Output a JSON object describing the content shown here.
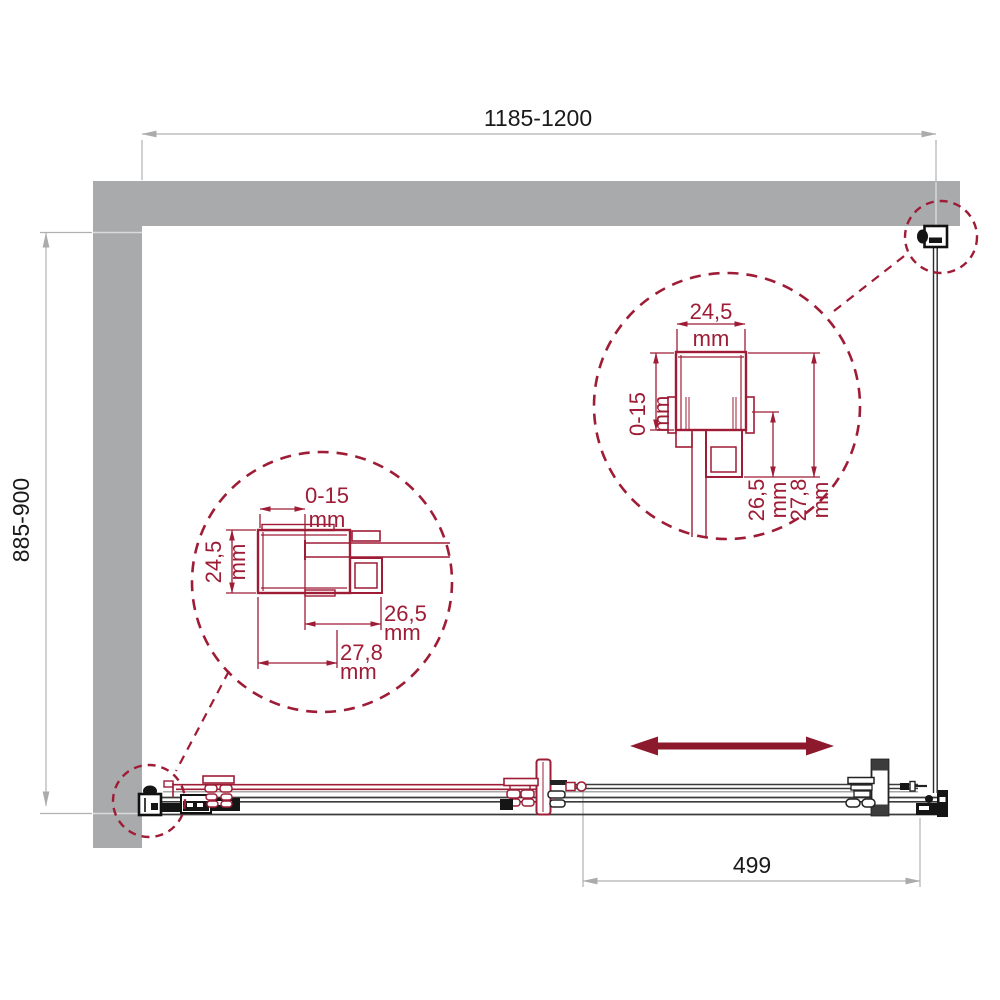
{
  "dimensions": {
    "overall_width": "1185-1200",
    "overall_depth": "885-900",
    "door_travel": "499"
  },
  "detail_right": {
    "profile_width": "24,5",
    "adjustment_range": "0-15",
    "inner_depth": "26,5",
    "outer_depth": "27,8",
    "unit": "mm"
  },
  "detail_left": {
    "profile_width": "24,5",
    "adjustment_range": "0-15",
    "inner_depth": "26,5",
    "outer_depth": "27,8",
    "unit": "mm"
  },
  "colors": {
    "accent": "#9E1C36",
    "arrow": "#8C1A2C",
    "wall": "#A9AAAC",
    "dim_line": "#B0B0B1",
    "ink": "#1A1A1A"
  }
}
